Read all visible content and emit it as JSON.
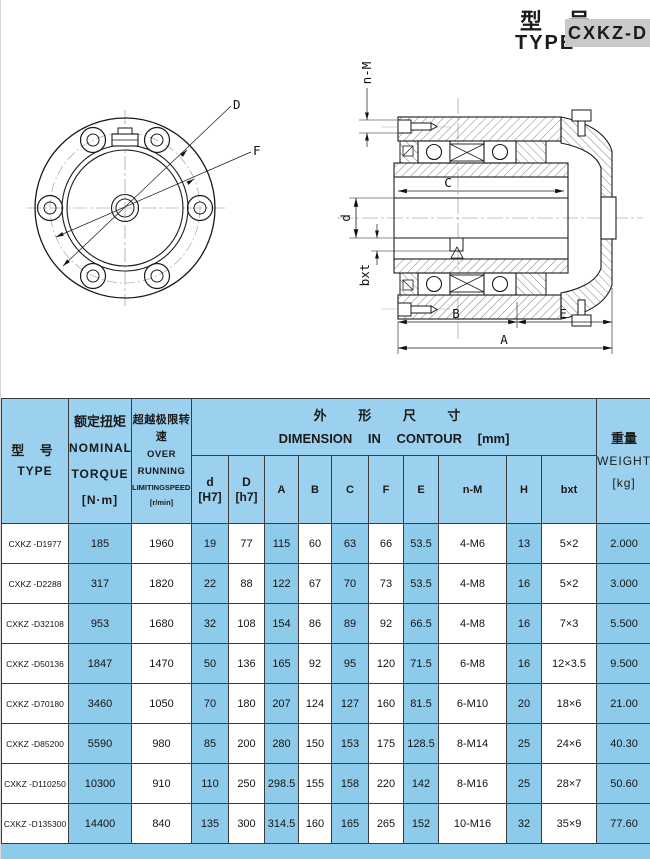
{
  "colors": {
    "accent_blue": "#8ecbeb",
    "header_blue": "#9bd1ee",
    "model_badge_gray": "#c9c9c9"
  },
  "title": {
    "cn": "型 号",
    "en": "TYPE",
    "model": "CXKZ-D"
  },
  "drawing": {
    "front_view": {
      "label_D": "D",
      "label_F": "F"
    },
    "section_view": {
      "label_nM": "n-M",
      "label_C": "C",
      "label_d": "d",
      "label_bxt": "bxt",
      "label_B": "B",
      "label_E": "E",
      "label_A": "A"
    }
  },
  "table": {
    "headers": {
      "type_cn": "型 号",
      "type_en": "TYPE",
      "torque_cn": "额定扭矩",
      "torque_en1": "NOMINAL",
      "torque_en2": "TORQUE",
      "torque_unit": "[N·m]",
      "speed_cn": "超越极限转速",
      "speed_en1": "OVER RUNNING",
      "speed_en2": "LIMITINGSPEEDS",
      "speed_unit": "[r/min]",
      "dim_cn": "外 形 尺 寸",
      "dim_en": "DIMENSION IN CONTOUR [mm]",
      "sub": {
        "d_sym": "d",
        "d_tol": "[H7]",
        "D_sym": "D",
        "D_tol": "[h7]",
        "A": "A",
        "B": "B",
        "C": "C",
        "F": "F",
        "E": "E",
        "n_M": "n-M",
        "H": "H",
        "bxt": "bxt"
      },
      "weight_cn": "重量",
      "weight_en": "WEIGHT",
      "weight_unit": "[kg]"
    },
    "rows": [
      [
        "CXKZ -D1977",
        "185",
        "1960",
        "19",
        "77",
        "115",
        "60",
        "63",
        "66",
        "53.5",
        "4-M6",
        "13",
        "5×2",
        "2.000"
      ],
      [
        "CXKZ -D2288",
        "317",
        "1820",
        "22",
        "88",
        "122",
        "67",
        "70",
        "73",
        "53.5",
        "4-M8",
        "16",
        "5×2",
        "3.000"
      ],
      [
        "CXKZ -D32108",
        "953",
        "1680",
        "32",
        "108",
        "154",
        "86",
        "89",
        "92",
        "66.5",
        "4-M8",
        "16",
        "7×3",
        "5.500"
      ],
      [
        "CXKZ -D50136",
        "1847",
        "1470",
        "50",
        "136",
        "165",
        "92",
        "95",
        "120",
        "71.5",
        "6-M8",
        "16",
        "12×3.5",
        "9.500"
      ],
      [
        "CXKZ -D70180",
        "3460",
        "1050",
        "70",
        "180",
        "207",
        "124",
        "127",
        "160",
        "81.5",
        "6-M10",
        "20",
        "18×6",
        "21.00"
      ],
      [
        "CXKZ -D85200",
        "5590",
        "980",
        "85",
        "200",
        "280",
        "150",
        "153",
        "175",
        "128.5",
        "8-M14",
        "25",
        "24×6",
        "40.30"
      ],
      [
        "CXKZ -D110250",
        "10300",
        "910",
        "110",
        "250",
        "298.5",
        "155",
        "158",
        "220",
        "142",
        "8-M16",
        "25",
        "28×7",
        "50.60"
      ],
      [
        "CXKZ -D135300",
        "14400",
        "840",
        "135",
        "300",
        "314.5",
        "160",
        "165",
        "265",
        "152",
        "10-M16",
        "32",
        "35×9",
        "77.60"
      ]
    ]
  }
}
